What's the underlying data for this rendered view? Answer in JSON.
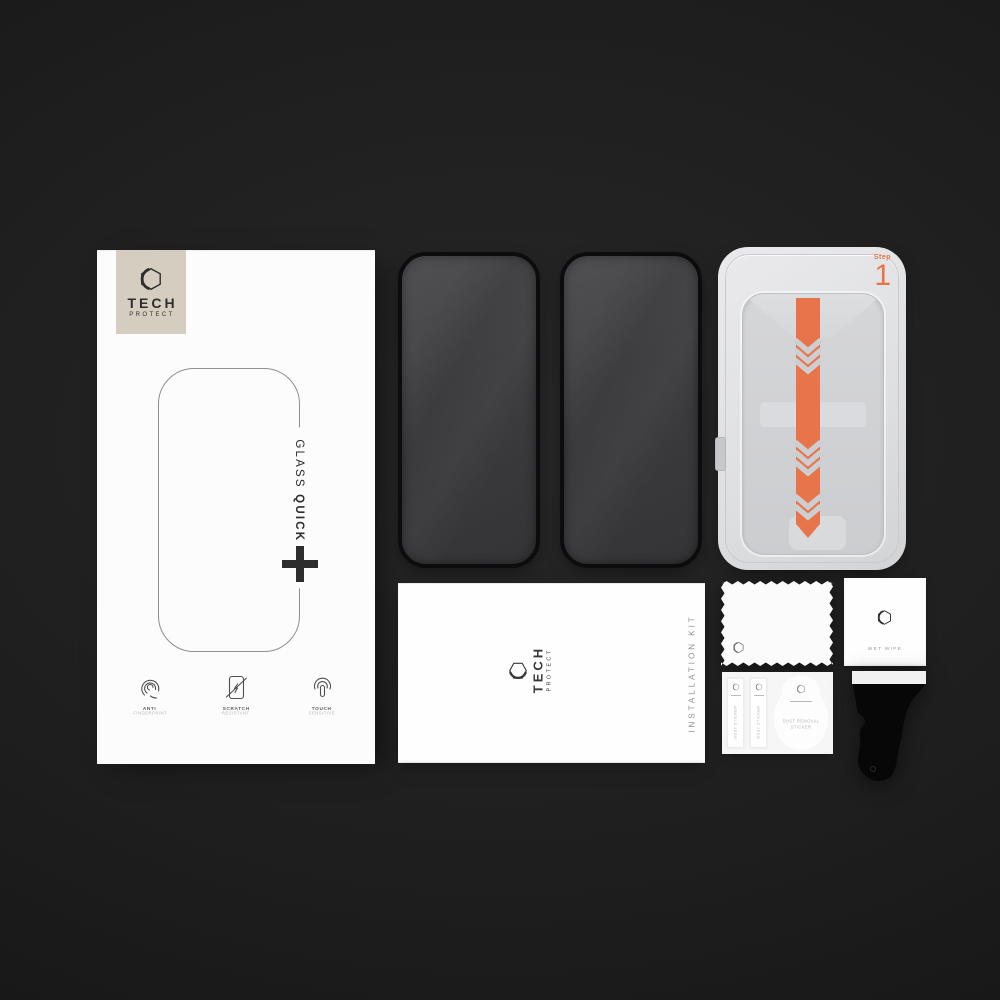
{
  "brand": {
    "name_line1": "TECH",
    "name_line2": "PROTECT"
  },
  "box": {
    "title_glass": "GLASS",
    "title_quick_set": "QUICK SET",
    "features": [
      {
        "title": "ANTI",
        "subtitle": "FINGERPRINT"
      },
      {
        "title": "SCRATCH",
        "subtitle": "RESISTANT"
      },
      {
        "title": "TOUCH",
        "subtitle": "SENSITIVE"
      }
    ]
  },
  "tray": {
    "step_label": "Step",
    "step_number": "1",
    "accent_color": "#E8744A"
  },
  "envelope": {
    "kit_label": "INSTALLATION KIT"
  },
  "wet_wipe": {
    "label": "WET WIPE"
  },
  "dust_stickers": {
    "strip_label": "DUST STICKER",
    "removal_label_line1": "DUST REMOVAL",
    "removal_label_line2": "STICKER"
  },
  "icons": {
    "brand": "hexagon-logo-icon",
    "feature_icons": [
      "fingerprint-icon",
      "scratch-resistant-icon",
      "touch-sensitive-icon"
    ],
    "pull_tab": "chevron-down-arrows-icon"
  },
  "colors": {
    "accent_orange": "#E8744A",
    "label_beige": "#D5CEC0",
    "background_dark": "#1E1E1E",
    "glass_dark": "#3D3D40"
  }
}
